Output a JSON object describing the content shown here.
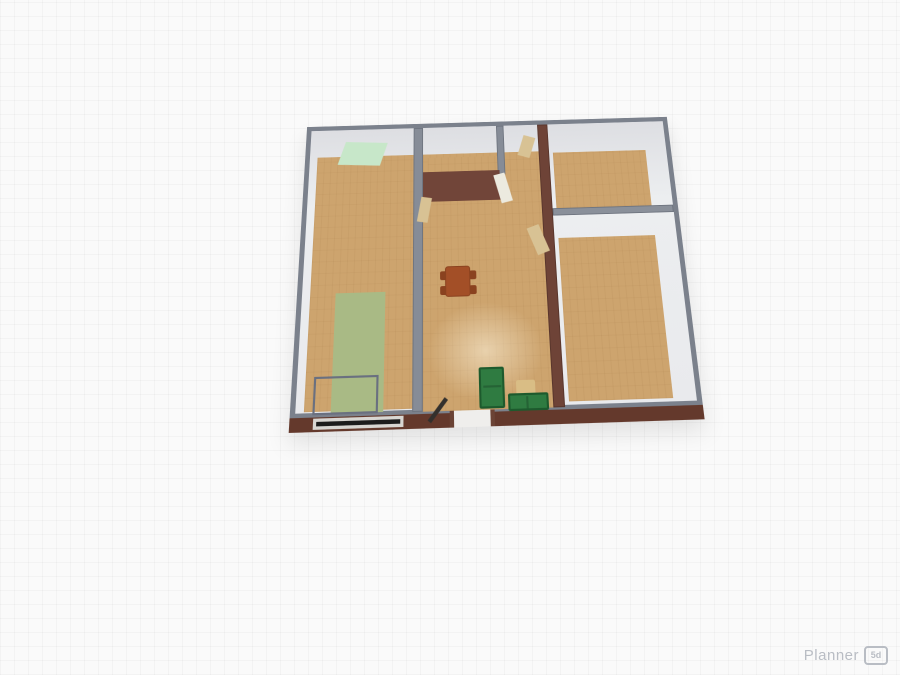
{
  "logo": {
    "text": "Planner",
    "badge": "5d"
  },
  "plan": {
    "position": {
      "left": 299,
      "top": 107
    },
    "size": {
      "w": 386,
      "h": 312
    },
    "colors": {
      "wall_gray": "#7b818c",
      "wall_inner_face": "#e9eaed",
      "wall_brick": "#6e4337",
      "wall_exterior_brown": "#64392c",
      "floor_wood": "#cda46e",
      "door_tan": "#d8c294",
      "door_white": "#eceadf",
      "sofa_green": "#2f7b41",
      "table_redbrown": "#a34f27",
      "rug_mint": "#c7e7c9",
      "rug_sage": "#a9ba85"
    },
    "elements": [
      {
        "name": "outer-wall-shell",
        "cls": "shell",
        "x": 0,
        "y": 0,
        "w": 386,
        "h": 300,
        "border": "5px solid #7b818c",
        "inter": false
      },
      {
        "name": "south-exterior-wall",
        "x": 0,
        "y": 299,
        "w": 386,
        "h": 13,
        "bg": "#64392c",
        "inter": false
      },
      {
        "name": "floor-left-room",
        "cls": "wood",
        "x": 13,
        "y": 36,
        "w": 101,
        "h": 258,
        "inter": true
      },
      {
        "name": "floor-middle-room",
        "cls": "wood",
        "x": 124,
        "y": 36,
        "w": 122,
        "h": 261,
        "inter": true
      },
      {
        "name": "floor-highlight",
        "x": 128,
        "y": 195,
        "w": 112,
        "h": 95,
        "bg": "radial-gradient(ellipse at center, rgba(255,246,224,0.55) 0%, rgba(255,246,224,0) 70%)",
        "inter": false
      },
      {
        "name": "floor-small-room",
        "cls": "wood",
        "x": 129,
        "y": 40,
        "w": 74,
        "h": 20,
        "inter": true
      },
      {
        "name": "floor-right-top-room",
        "cls": "wood",
        "x": 261,
        "y": 38,
        "w": 98,
        "h": 62,
        "inter": true
      },
      {
        "name": "floor-right-bottom-room",
        "cls": "wood",
        "x": 261,
        "y": 132,
        "w": 98,
        "h": 160,
        "inter": true
      },
      {
        "name": "rug-mint",
        "x": 38,
        "y": 20,
        "w": 45,
        "h": 26,
        "bg": "#c7e7c9",
        "transform": "skewX(-14deg) rotate(3deg)",
        "inter": true
      },
      {
        "name": "rug-sage",
        "x": 38,
        "y": 182,
        "w": 49,
        "h": 114,
        "bg": "#a9ba85",
        "inter": true
      },
      {
        "name": "low-partition-wall",
        "x": 21,
        "y": 262,
        "w": 61,
        "h": 35,
        "border": "2px solid #6a7080",
        "inter": false
      },
      {
        "name": "interior-wall-left",
        "x": 114,
        "y": 5,
        "w": 10,
        "h": 292,
        "bg": "#868c97",
        "border": "1px solid #6f7580",
        "inter": false
      },
      {
        "name": "interior-wall-brick",
        "x": 246,
        "y": 5,
        "w": 11,
        "h": 292,
        "bg": "#6e4337",
        "border": "1px solid #5a362c",
        "inter": false
      },
      {
        "name": "small-room-right-wall",
        "x": 202,
        "y": 5,
        "w": 8,
        "h": 56,
        "bg": "#868c97",
        "border": "1px solid #6f7580",
        "inter": false
      },
      {
        "name": "small-room-south-wall",
        "x": 124,
        "y": 56,
        "w": 80,
        "h": 33,
        "bg": "#714539",
        "inter": false
      },
      {
        "name": "right-rooms-divider-wall",
        "x": 257,
        "y": 100,
        "w": 124,
        "h": 8,
        "bg": "#8a909a",
        "border": "1px solid #6f7580",
        "inter": false
      },
      {
        "name": "door-top-passage",
        "x": 227,
        "y": 18,
        "w": 13,
        "h": 24,
        "bg": "#d8c294",
        "transform": "rotate(18deg)",
        "inter": true
      },
      {
        "name": "door-right-room",
        "x": 234,
        "y": 118,
        "w": 13,
        "h": 30,
        "bg": "#d8c294",
        "transform": "rotate(-20deg)",
        "inter": true
      },
      {
        "name": "door-small-room-white",
        "x": 201,
        "y": 60,
        "w": 12,
        "h": 32,
        "bg": "#eceadf",
        "transform": "rotate(-14deg)",
        "inter": true
      },
      {
        "name": "door-left-room",
        "x": 120,
        "y": 84,
        "w": 11,
        "h": 27,
        "bg": "#d8c294",
        "transform": "rotate(10deg)",
        "inter": true
      },
      {
        "name": "dining-chair",
        "x": 141,
        "y": 163,
        "w": 7,
        "h": 9,
        "bg": "#8a421f",
        "radius": 2,
        "inter": true
      },
      {
        "name": "dining-chair",
        "x": 141,
        "y": 178,
        "w": 7,
        "h": 9,
        "bg": "#8a421f",
        "radius": 2,
        "inter": true
      },
      {
        "name": "dining-chair",
        "x": 170,
        "y": 163,
        "w": 7,
        "h": 9,
        "bg": "#8a421f",
        "radius": 2,
        "inter": true
      },
      {
        "name": "dining-chair",
        "x": 170,
        "y": 178,
        "w": 7,
        "h": 9,
        "bg": "#8a421f",
        "radius": 2,
        "inter": true
      },
      {
        "name": "dining-table",
        "x": 146,
        "y": 158,
        "w": 25,
        "h": 31,
        "bg": "#a34f27",
        "radius": 3,
        "border": "1px solid #8a421f",
        "inter": true
      },
      {
        "name": "sofa-vertical",
        "x": 177,
        "y": 258,
        "w": 24,
        "h": 38,
        "bg": "#2f7b41",
        "border": "2px solid #1d5a2d",
        "radius": 2,
        "inter": true
      },
      {
        "name": "sofa-vertical-seam",
        "x": 181,
        "y": 275,
        "w": 17,
        "h": 2,
        "bg": "#256335",
        "inter": false
      },
      {
        "name": "armchair-tan",
        "x": 212,
        "y": 271,
        "w": 18,
        "h": 17,
        "bg": "#d9bd85",
        "radius": 2,
        "inter": true
      },
      {
        "name": "sofa-horizontal",
        "x": 204,
        "y": 283,
        "w": 38,
        "h": 16,
        "bg": "#2f7b41",
        "border": "2px solid #1d5a2d",
        "radius": 2,
        "inter": true
      },
      {
        "name": "sofa-horizontal-seam",
        "x": 221,
        "y": 286,
        "w": 2,
        "h": 11,
        "bg": "#256335",
        "inter": false
      },
      {
        "name": "front-door-opening",
        "x": 152,
        "y": 297,
        "w": 36,
        "h": 15,
        "bg": "#efeeec",
        "inter": false
      },
      {
        "name": "front-door-post",
        "x": 149,
        "y": 297,
        "w": 4,
        "h": 15,
        "bg": "#6b4335",
        "inter": false
      },
      {
        "name": "front-door-post",
        "x": 187,
        "y": 297,
        "w": 4,
        "h": 15,
        "bg": "#6b4335",
        "inter": false
      },
      {
        "name": "front-door-panel",
        "x": 136,
        "y": 283,
        "w": 4,
        "h": 26,
        "bg": "#33302d",
        "transform": "rotate(38deg)",
        "inter": true
      },
      {
        "name": "window-frame",
        "x": 22,
        "y": 300,
        "w": 84,
        "h": 10,
        "bg": "#d8d6d2",
        "inter": true
      },
      {
        "name": "window-glass",
        "x": 25,
        "y": 303,
        "w": 78,
        "h": 4,
        "bg": "#1c1c1c",
        "inter": false
      }
    ]
  }
}
